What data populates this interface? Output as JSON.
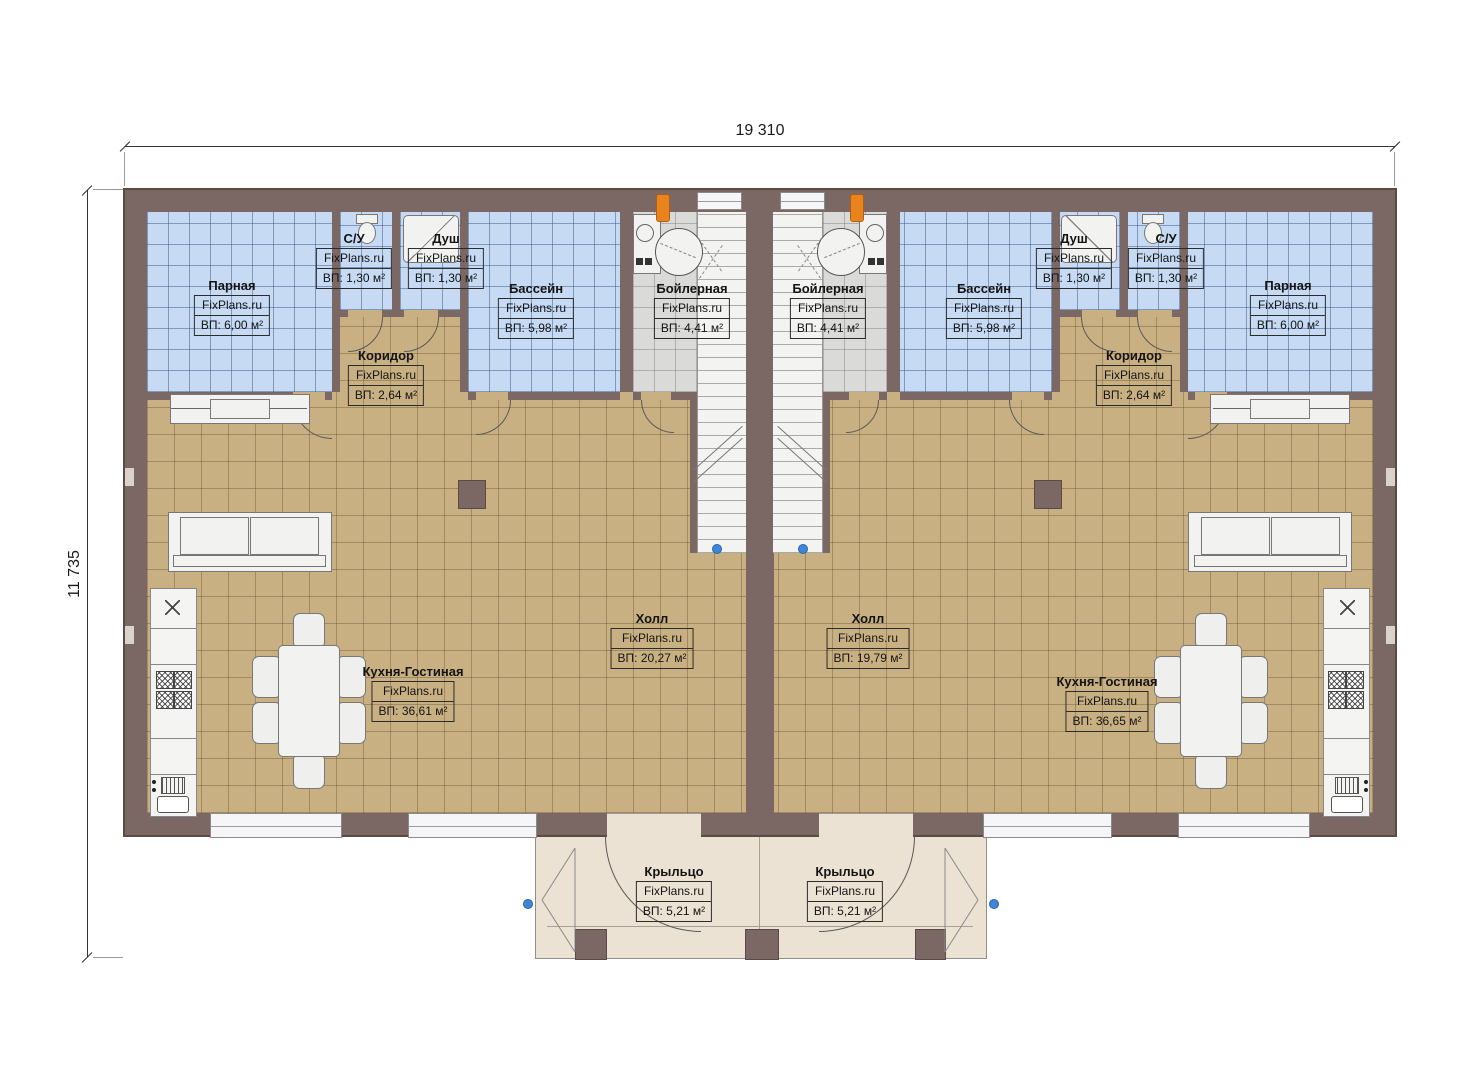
{
  "watermark": "FixPlans.ru",
  "dimensions": {
    "width_total": "19 310",
    "height_total": "11 735"
  },
  "rooms": {
    "parnaya_left": {
      "name": "Парная",
      "area": "ВП: 6,00 м²"
    },
    "su_left": {
      "name": "С/У",
      "area": "ВП: 1,30 м²"
    },
    "dush_left": {
      "name": "Душ",
      "area": "ВП: 1,30 м²"
    },
    "bassein_left": {
      "name": "Бассейн",
      "area": "ВП: 5,98 м²"
    },
    "boiler_left": {
      "name": "Бойлерная",
      "area": "ВП: 4,41 м²"
    },
    "koridor_left": {
      "name": "Коридор",
      "area": "ВП: 2,64 м²"
    },
    "holl_left": {
      "name": "Холл",
      "area": "ВП: 20,27 м²"
    },
    "kitchen_left": {
      "name": "Кухня-Гостиная",
      "area": "ВП: 36,61 м²"
    },
    "porch_left": {
      "name": "Крыльцо",
      "area": "ВП: 5,21 м²"
    },
    "parnaya_right": {
      "name": "Парная",
      "area": "ВП: 6,00 м²"
    },
    "su_right": {
      "name": "С/У",
      "area": "ВП: 1,30 м²"
    },
    "dush_right": {
      "name": "Душ",
      "area": "ВП: 1,30 м²"
    },
    "bassein_right": {
      "name": "Бассейн",
      "area": "ВП: 5,98 м²"
    },
    "boiler_right": {
      "name": "Бойлерная",
      "area": "ВП: 4,41 м²"
    },
    "koridor_right": {
      "name": "Коридор",
      "area": "ВП: 2,64 м²"
    },
    "holl_right": {
      "name": "Холл",
      "area": "ВП: 19,79 м²"
    },
    "kitchen_right": {
      "name": "Кухня-Гостиная",
      "area": "ВП: 36,65 м²"
    },
    "porch_right": {
      "name": "Крыльцо",
      "area": "ВП: 5,21 м²"
    }
  },
  "colors": {
    "wall": "#7b6865",
    "tile_blue": "#c6daf3",
    "tile_tan": "#c9b083",
    "tile_gray": "#dadad8",
    "porch_floor": "#ece2d4",
    "boiler_marker_orange": "#e8831e",
    "node_marker_blue": "#3f86d8"
  }
}
